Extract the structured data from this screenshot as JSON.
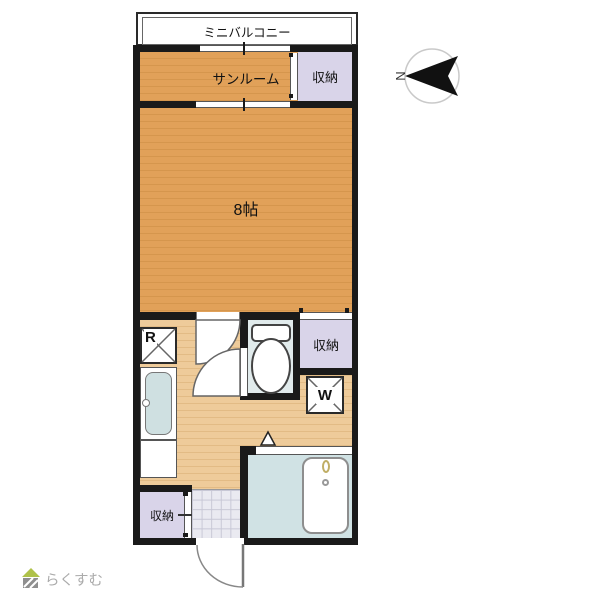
{
  "floorplan": {
    "balcony": {
      "label": "ミニバルコニー"
    },
    "sunroom": {
      "label": "サンルーム"
    },
    "closet_top_right": {
      "label": "収納"
    },
    "main_room": {
      "label": "8帖"
    },
    "refrigerator": {
      "label": "R"
    },
    "closet_middle_right": {
      "label": "収納"
    },
    "washer": {
      "label": "W"
    },
    "closet_bottom_left": {
      "label": "収納"
    },
    "compass": {
      "north_label": "N"
    }
  },
  "watermark": {
    "logo_text": "らくすむ"
  },
  "colors": {
    "wall": "#1a1a1a",
    "wood_floor": "#e1a159",
    "kitchen_floor": "#eecb9a",
    "closet_fill": "#d9d4e9",
    "toilet_floor": "#e1ebec",
    "bath_floor": "#d0e2e4",
    "entry_tile": "#eaeaf1",
    "sink_fill": "#cfe0e1",
    "logo_roof": "#afc24a",
    "logo_text_color": "#ababab"
  }
}
